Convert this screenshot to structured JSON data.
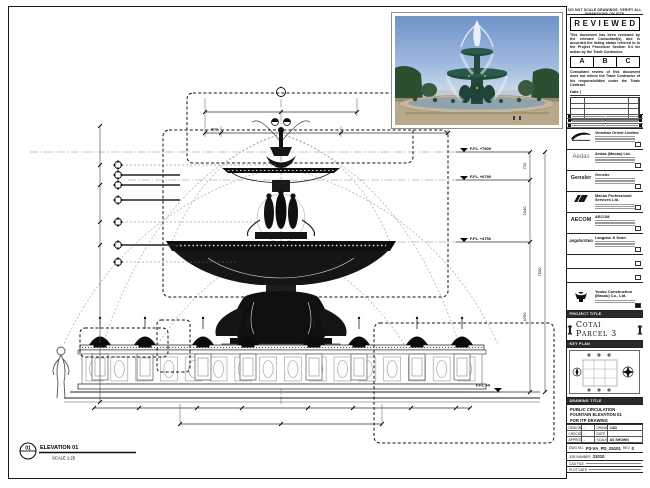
{
  "panel": {
    "note_top": "DO NOT SCALE DRAWINGS. VERIFY ALL DIMENSIONS ON SITE.",
    "stamp": {
      "title": "REVIEWED",
      "para1": "This document has been reviewed by the relevant Consultant(s) and is accorded the listing status referred to in the Project Procedure Section 5.4 for action by the Trade Contractor.",
      "grades": [
        "A",
        "B",
        "C"
      ],
      "para2": "Consultant review of this document does not relieve the Trade Contractor of his responsibilities under the Trade Contract.",
      "date_label": "Date |"
    },
    "consultants": [
      {
        "name": "Venetian Orient Limited",
        "logo_text": ""
      },
      {
        "name": "Aedas (Macau) Ltd.",
        "logo_text": "Aedas"
      },
      {
        "name": "Gensler",
        "logo_text": "Gensler"
      },
      {
        "name": "Macau Professional Services Ltd.",
        "logo_text": ""
      },
      {
        "name": "AECOM",
        "logo_text": "AECOM"
      },
      {
        "name": "Langdon & Seah",
        "logo_text": "LangdonSeah"
      }
    ],
    "contractor": {
      "name": "Youbo Construction (Macau) Co., Ltd."
    },
    "project": {
      "header": "PROJECT TITLE",
      "title": "Cotai Parcel 3"
    },
    "keyplan": {
      "header": "KEY PLAN"
    },
    "titleblock": {
      "header": "DRAWING TITLE",
      "line1": "PUBLIC CIRCULATION",
      "line2": "FOUNTAIN ELEVATION 01",
      "line3": "FOR ITP DRAWING",
      "rows": [
        {
          "l1": "DESIGNED",
          "v1": "-",
          "l2": "DRAWN",
          "v2": "CAD"
        },
        {
          "l1": "CHECKED",
          "v1": "-",
          "l2": "DATE",
          "v2": ""
        },
        {
          "l1": "APPROVED",
          "v1": "-",
          "l2": "SCALE",
          "v2": "AS SHOWN"
        }
      ],
      "dwg_label": "DWG NO.",
      "dwg_no": "P3-VA_PD_25101",
      "rev_label": "REV",
      "rev": "0",
      "job_label": "JOB NUMBER",
      "job_no": "31010",
      "file_label": "CAD FILE",
      "plot_label": "PLOT DATE"
    }
  },
  "drawing": {
    "levels": [
      "F.F.L +7500",
      "F.F.L +6790",
      "F.F.L +4750",
      "F.F.L +0"
    ],
    "vdims": [
      "710",
      "2040",
      "4750",
      "7500"
    ],
    "topdims": [
      "800"
    ],
    "elevation": {
      "number": "01",
      "title": "ELEVATION 01",
      "scale": "SCALE 1:25"
    }
  }
}
